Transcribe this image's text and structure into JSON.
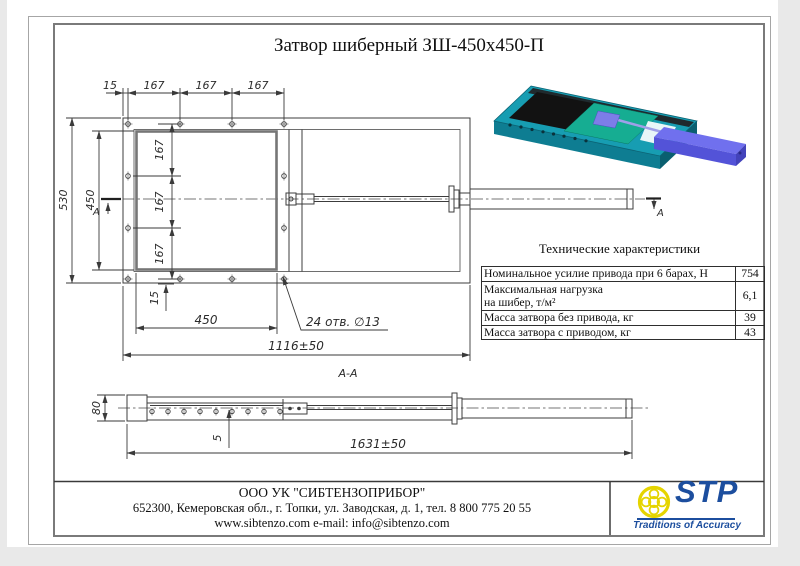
{
  "title": "Затвор шиберный ЗШ-450х450-П",
  "drawing": {
    "section_label": "A-A",
    "cut_letter": "A",
    "dims": {
      "d15": "15",
      "d167": "167",
      "d530": "530",
      "d450": "450",
      "d1116": "1116±50",
      "holes_note": "24 отв. ∅13",
      "d80": "80",
      "d5": "5",
      "d1631": "1631±50"
    }
  },
  "specs": {
    "title": "Технические характеристики",
    "rows": [
      {
        "label": "Номинальное усилие привода при 6 барах, Н",
        "value": "754"
      },
      {
        "label": "Максимальная нагрузка",
        "label2": "на шибер, т/м²",
        "value": "6,1"
      },
      {
        "label": "Масса затвора без привода, кг",
        "value": "39"
      },
      {
        "label": "Масса затвора с приводом, кг",
        "value": "43"
      }
    ]
  },
  "footer": {
    "company": "ООО УК \"СИБТЕНЗОПРИБОР\"",
    "address": "652300, Кемеровская обл., г. Топки, ул. Заводская, д. 1, тел. 8 800 775 20 55",
    "contacts": "www.sibtenzo.com e-mail: info@sibtenzo.com"
  },
  "logo": {
    "name": "STP",
    "tagline": "Traditions of Accuracy"
  }
}
